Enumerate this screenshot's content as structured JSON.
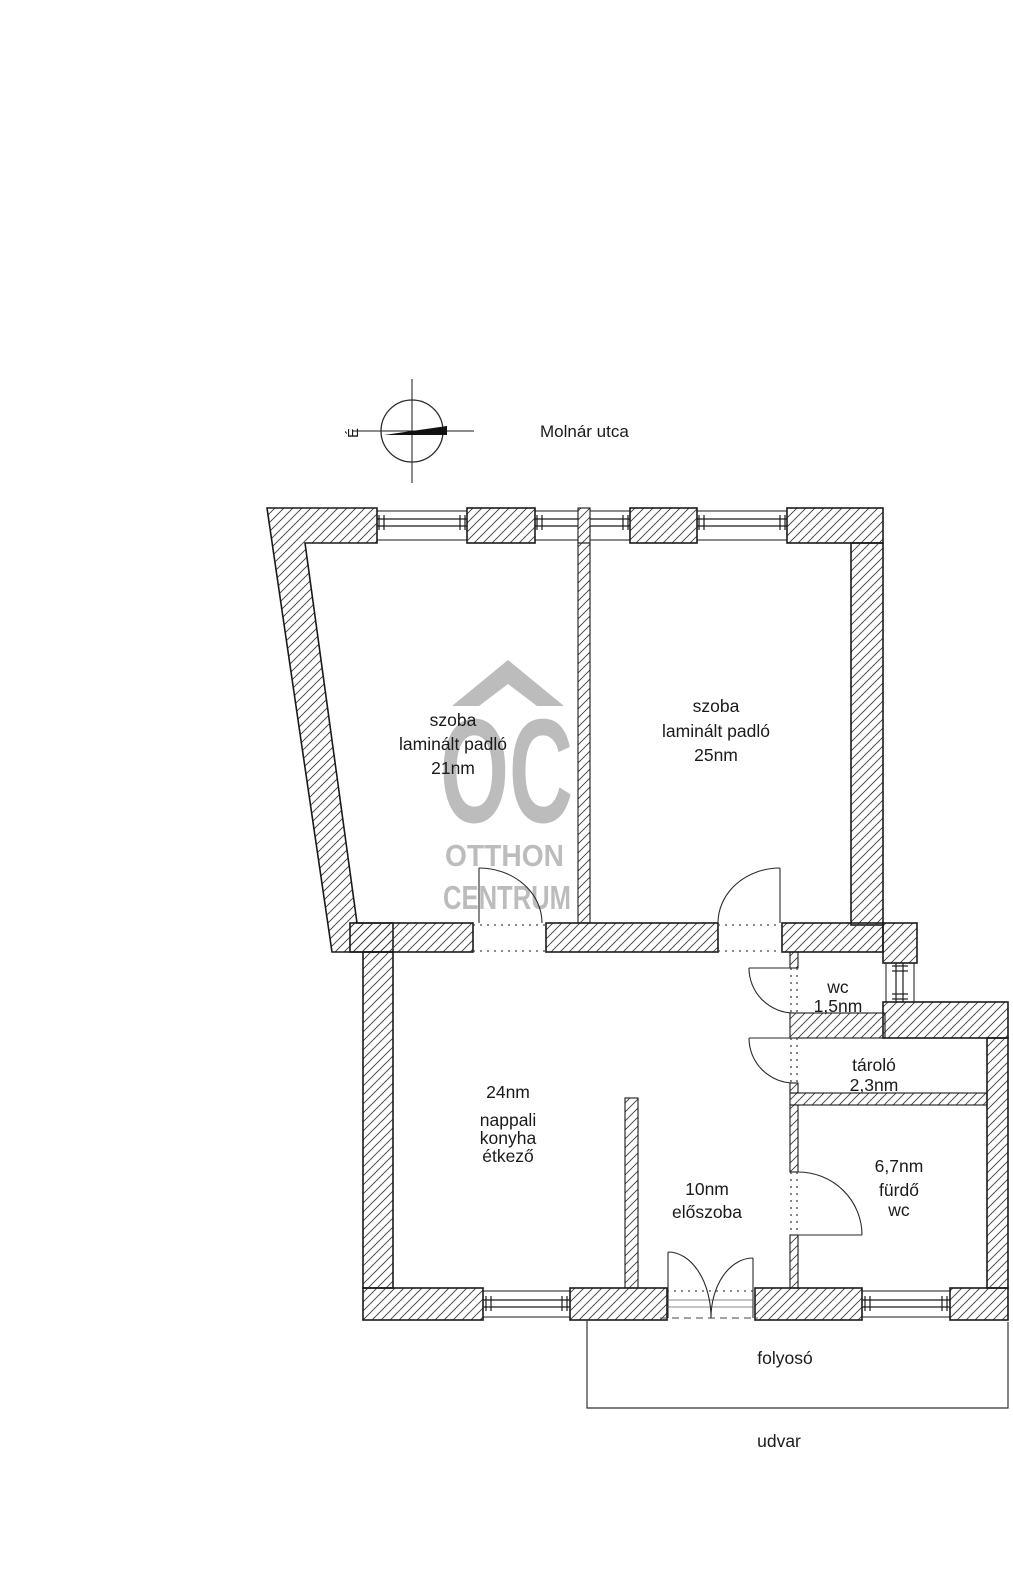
{
  "compass": {
    "north": "É"
  },
  "street": {
    "name": "Molnár utca"
  },
  "watermark": {
    "logo": "OC",
    "brand_line1": "OTTHON",
    "brand_line2": "CENTRUM"
  },
  "rooms": {
    "bedroom_left": {
      "name": "szoba",
      "floor": "laminált padló",
      "area": "21nm"
    },
    "bedroom_right": {
      "name": "szoba",
      "floor": "laminált padló",
      "area": "25nm"
    },
    "wc": {
      "name": "wc",
      "area": "1,5nm"
    },
    "storage": {
      "name": "tároló",
      "area": "2,3nm"
    },
    "living": {
      "area": "24nm",
      "name_line1": "nappali",
      "name_line2": "konyha",
      "name_line3": "étkező"
    },
    "hallway": {
      "area": "10nm",
      "name": "előszoba"
    },
    "bathroom": {
      "area": "6,7nm",
      "name_line1": "fürdő",
      "name_line2": "wc"
    }
  },
  "outside": {
    "corridor": "folyosó",
    "courtyard": "udvar"
  },
  "colors": {
    "background": "#ffffff",
    "wall_outline": "#1a1a1a",
    "hatch": "#3c3c3c",
    "watermark": "#b9b9b9"
  }
}
